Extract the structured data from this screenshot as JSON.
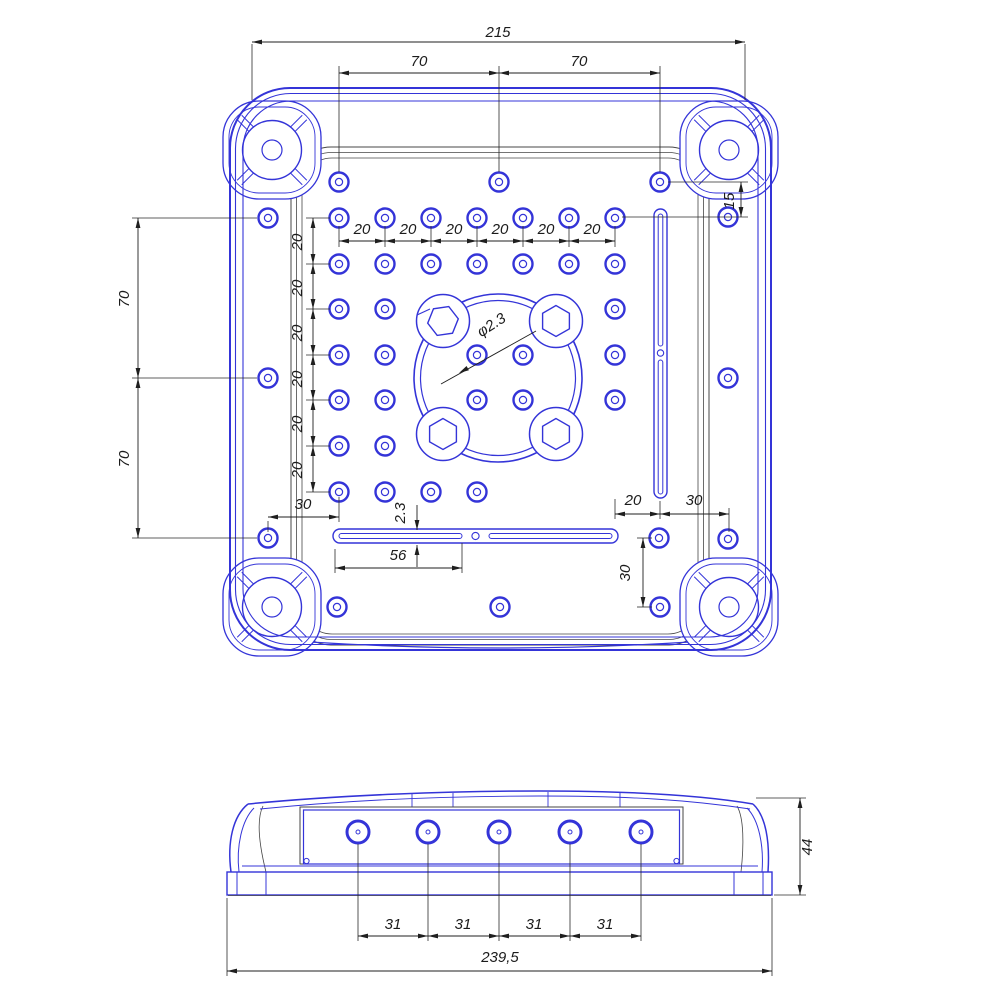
{
  "drawing": {
    "kind": "technical-drawing-enclosure-base",
    "colors": {
      "blue": "#3434d8",
      "dark": "#454545",
      "dim": "#1f1f1f",
      "bg": "#ffffff"
    },
    "top_view": {
      "labels": {
        "overall_width": "215",
        "top_pitch": [
          "70",
          "70"
        ],
        "row_offset": "15",
        "col_pitch": [
          "20",
          "20",
          "20",
          "20",
          "20",
          "20"
        ],
        "row_pitch": [
          "20",
          "20",
          "20",
          "20",
          "20",
          "20"
        ],
        "left_pitch": [
          "70",
          "70"
        ],
        "hole_diameter": "φ2.3",
        "slot_width": "2.3",
        "slot_length": "56",
        "edge_offset_left": "30",
        "slot_offset": "20",
        "edge_offset_right": "30",
        "bottom_offset": "30"
      },
      "holes": [
        [
          339,
          182
        ],
        [
          499,
          182
        ],
        [
          660,
          182
        ],
        [
          268,
          218
        ],
        [
          728,
          217
        ],
        [
          339,
          218
        ],
        [
          385,
          218
        ],
        [
          431,
          218
        ],
        [
          477,
          218
        ],
        [
          523,
          218
        ],
        [
          569,
          218
        ],
        [
          615,
          218
        ],
        [
          339,
          264
        ],
        [
          385,
          264
        ],
        [
          431,
          264
        ],
        [
          477,
          264
        ],
        [
          523,
          264
        ],
        [
          569,
          264
        ],
        [
          615,
          264
        ],
        [
          339,
          309
        ],
        [
          385,
          309
        ],
        [
          615,
          309
        ],
        [
          339,
          355
        ],
        [
          385,
          355
        ],
        [
          477,
          355
        ],
        [
          523,
          355
        ],
        [
          615,
          355
        ],
        [
          339,
          400
        ],
        [
          385,
          400
        ],
        [
          477,
          400
        ],
        [
          523,
          400
        ],
        [
          615,
          400
        ],
        [
          339,
          446
        ],
        [
          385,
          446
        ],
        [
          339,
          492
        ],
        [
          385,
          492
        ],
        [
          431,
          492
        ],
        [
          477,
          492
        ],
        [
          268,
          378
        ],
        [
          728,
          378
        ],
        [
          268,
          538
        ],
        [
          659,
          538
        ],
        [
          728,
          539
        ],
        [
          337,
          607
        ],
        [
          500,
          607
        ],
        [
          660,
          607
        ]
      ],
      "corner_bosses": [
        [
          272,
          150
        ],
        [
          729,
          150
        ],
        [
          272,
          607
        ],
        [
          729,
          607
        ]
      ],
      "ring": {
        "cx": 498,
        "cy": 378,
        "r_outer": 84,
        "r_inner": 77.5
      },
      "hex_bosses": {
        "centers": [
          [
            443,
            321
          ],
          [
            556,
            321
          ],
          [
            443,
            434
          ],
          [
            556,
            434
          ]
        ],
        "circle_r": 26.5,
        "hex_r": 15.5
      },
      "slot_vertical": {
        "x": 654,
        "y": 209,
        "w": 13,
        "h": 289,
        "circle": [
          660.5,
          353
        ]
      },
      "slot_bottom": {
        "x": 333,
        "y": 529,
        "w": 285,
        "h": 14,
        "circle": [
          475.5,
          536
        ]
      }
    },
    "side_view": {
      "labels": {
        "hole_pitch": [
          "31",
          "31",
          "31",
          "31"
        ],
        "overall_width": "239,5",
        "height": "44"
      },
      "holes_x": [
        358,
        428,
        499,
        570,
        641
      ],
      "holes_y": 832
    },
    "geometry": {
      "ext_lines": [
        [
          252,
          44,
          252,
          100
        ],
        [
          745,
          44,
          745,
          100
        ],
        [
          339,
          66,
          339,
          172
        ],
        [
          499,
          66,
          499,
          172
        ],
        [
          660,
          66,
          660,
          172
        ],
        [
          668,
          182,
          748,
          182
        ],
        [
          622,
          217,
          748,
          217
        ],
        [
          339,
          226,
          339,
          247
        ],
        [
          385,
          226,
          385,
          247
        ],
        [
          431,
          226,
          431,
          247
        ],
        [
          477,
          226,
          477,
          247
        ],
        [
          523,
          226,
          523,
          247
        ],
        [
          569,
          226,
          569,
          247
        ],
        [
          615,
          226,
          615,
          247
        ],
        [
          132,
          218,
          257,
          218
        ],
        [
          132,
          378,
          257,
          378
        ],
        [
          132,
          538,
          257,
          538
        ],
        [
          306,
          218,
          330,
          218
        ],
        [
          306,
          264,
          330,
          264
        ],
        [
          306,
          309,
          330,
          309
        ],
        [
          306,
          355,
          330,
          355
        ],
        [
          306,
          400,
          330,
          400
        ],
        [
          306,
          446,
          330,
          446
        ],
        [
          306,
          492,
          330,
          492
        ],
        [
          335,
          549,
          335,
          573
        ],
        [
          462,
          543,
          462,
          573
        ],
        [
          268,
          521,
          268,
          532
        ],
        [
          339,
          497,
          339,
          522
        ],
        [
          615,
          499,
          615,
          519
        ],
        [
          660,
          501,
          660,
          519
        ],
        [
          729,
          508,
          729,
          532
        ],
        [
          637,
          538,
          652,
          538
        ],
        [
          637,
          607,
          652,
          607
        ],
        [
          358,
          844,
          358,
          941
        ],
        [
          428,
          844,
          428,
          941
        ],
        [
          499,
          844,
          499,
          941
        ],
        [
          570,
          844,
          570,
          941
        ],
        [
          641,
          844,
          641,
          941
        ],
        [
          227,
          898,
          227,
          976
        ],
        [
          772,
          898,
          772,
          976
        ],
        [
          756,
          798,
          806,
          798
        ],
        [
          774,
          895,
          806,
          895
        ]
      ],
      "dim_lines": [
        [
          252,
          42,
          745,
          42,
          1,
          1
        ],
        [
          339,
          73,
          499,
          73,
          1,
          1
        ],
        [
          499,
          73,
          660,
          73,
          1,
          1
        ],
        [
          741,
          182,
          741,
          217,
          1,
          1
        ],
        [
          339,
          241,
          385,
          241,
          1,
          1
        ],
        [
          385,
          241,
          431,
          241,
          1,
          1
        ],
        [
          431,
          241,
          477,
          241,
          1,
          1
        ],
        [
          477,
          241,
          523,
          241,
          1,
          1
        ],
        [
          523,
          241,
          569,
          241,
          1,
          1
        ],
        [
          569,
          241,
          615,
          241,
          1,
          1
        ],
        [
          138,
          218,
          138,
          378,
          1,
          1
        ],
        [
          138,
          378,
          138,
          538,
          1,
          1
        ],
        [
          313,
          218,
          313,
          264,
          1,
          1
        ],
        [
          313,
          264,
          313,
          309,
          1,
          1
        ],
        [
          313,
          309,
          313,
          355,
          1,
          1
        ],
        [
          313,
          355,
          313,
          400,
          1,
          1
        ],
        [
          313,
          400,
          313,
          446,
          1,
          1
        ],
        [
          313,
          446,
          313,
          492,
          1,
          1
        ],
        [
          417,
          505,
          417,
          530,
          0,
          1
        ],
        [
          417,
          545,
          417,
          567,
          1,
          0
        ],
        [
          335,
          568,
          462,
          568,
          1,
          1
        ],
        [
          268,
          517,
          339,
          517,
          1,
          1
        ],
        [
          615,
          514,
          660,
          514,
          1,
          1
        ],
        [
          660,
          514,
          729,
          514,
          1,
          1
        ],
        [
          643,
          538,
          643,
          607,
          1,
          1
        ],
        [
          358,
          936,
          428,
          936,
          1,
          1
        ],
        [
          428,
          936,
          499,
          936,
          1,
          1
        ],
        [
          499,
          936,
          570,
          936,
          1,
          1
        ],
        [
          570,
          936,
          641,
          936,
          1,
          1
        ],
        [
          227,
          971,
          772,
          971,
          1,
          1
        ],
        [
          800,
          798,
          800,
          895,
          1,
          1
        ]
      ],
      "leader": {
        "line": [
          536,
          331,
          441,
          384
        ],
        "arrow_at": [
          459,
          373
        ]
      }
    }
  }
}
